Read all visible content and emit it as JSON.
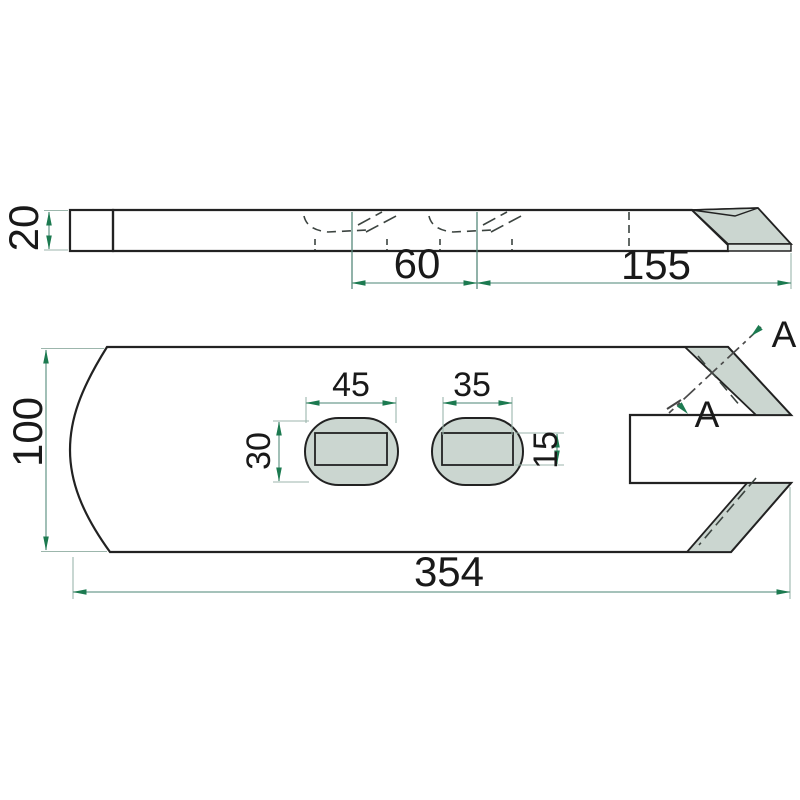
{
  "drawing": {
    "kind": "technical-drawing",
    "views": [
      "side-profile-view",
      "top-plan-view"
    ]
  },
  "dims": {
    "thickness": "20",
    "hole_spacing": "60",
    "tip_length": "155",
    "blade_width": "100",
    "slot_outer_width": "45",
    "slot_inner_width": "35",
    "slot_outer_height": "30",
    "slot_inner_height": "15",
    "total_length": "354"
  },
  "section": {
    "label_top": "A",
    "label_bottom": "A"
  },
  "colors": {
    "body": "#8eaca5",
    "light": "#cbd6d0",
    "band": "#e0e7e3",
    "outline": "#222222",
    "dim_arrow": "#1c7a50",
    "dim_line": "#6f9d90",
    "ext_line": "#9cb6ac",
    "text": "#191919"
  }
}
